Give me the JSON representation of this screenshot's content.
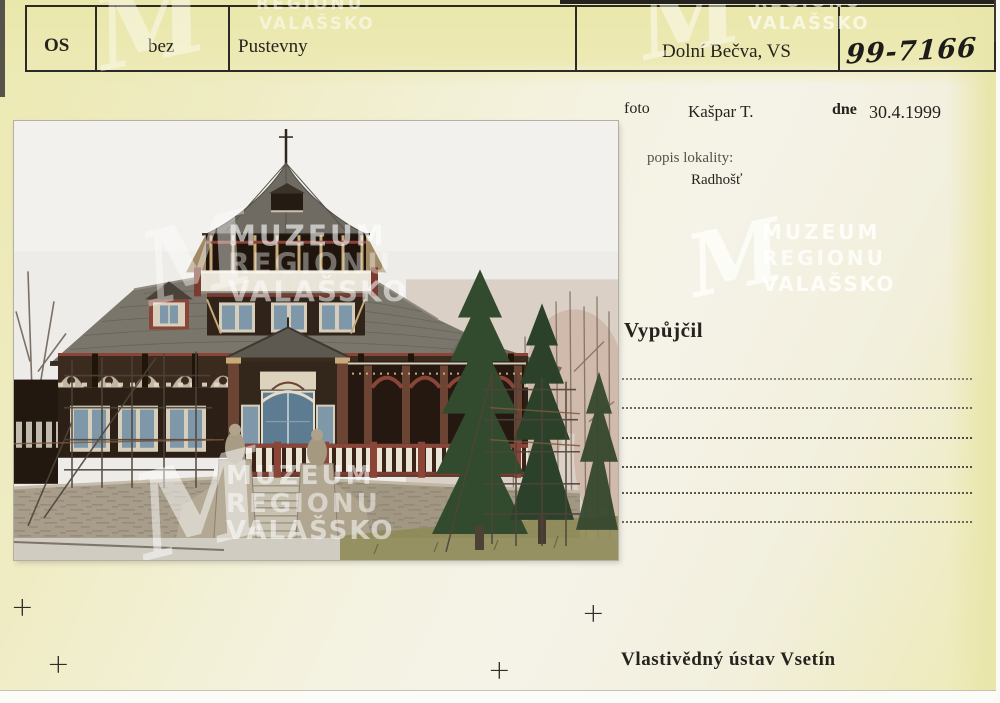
{
  "card": {
    "header_row": {
      "type_code": "OS",
      "negative": "bez",
      "title": "Pustevny",
      "location": "Dolní Bečva, VS",
      "inventory_number": "99-7166"
    },
    "photo_block": {
      "foto_label": "foto",
      "photographer": "Kašpar T.",
      "date_label": "dne",
      "date": "30.4.1999",
      "locality_label": "popis lokality:",
      "locality": "Radhošť"
    },
    "loan_section": {
      "heading": "Vypůjčil",
      "ruled_line_count": 6
    },
    "footer": {
      "institution": "Vlastivědný ústav Vsetín"
    },
    "registration_mark": "+"
  },
  "watermark": {
    "monogram": "M",
    "line1": "MUZEUM",
    "line2": "REGIONU",
    "line3": "VALAŠSKO"
  },
  "photo": {
    "description": "Wooden mountain chalet with tower, scaffolding, stone stair base and spruce trees",
    "colors": {
      "sky": "#edece8",
      "roof": "#7b766c",
      "dark_wood": "#2c1f15",
      "red_brown_trim": "#8a4538",
      "stone": "#a89d8a",
      "spruce": "#324a2e"
    }
  },
  "colors": {
    "card_yellow": "#ece9b2",
    "card_cream": "#f5f3e8",
    "ink": "#26231f"
  }
}
